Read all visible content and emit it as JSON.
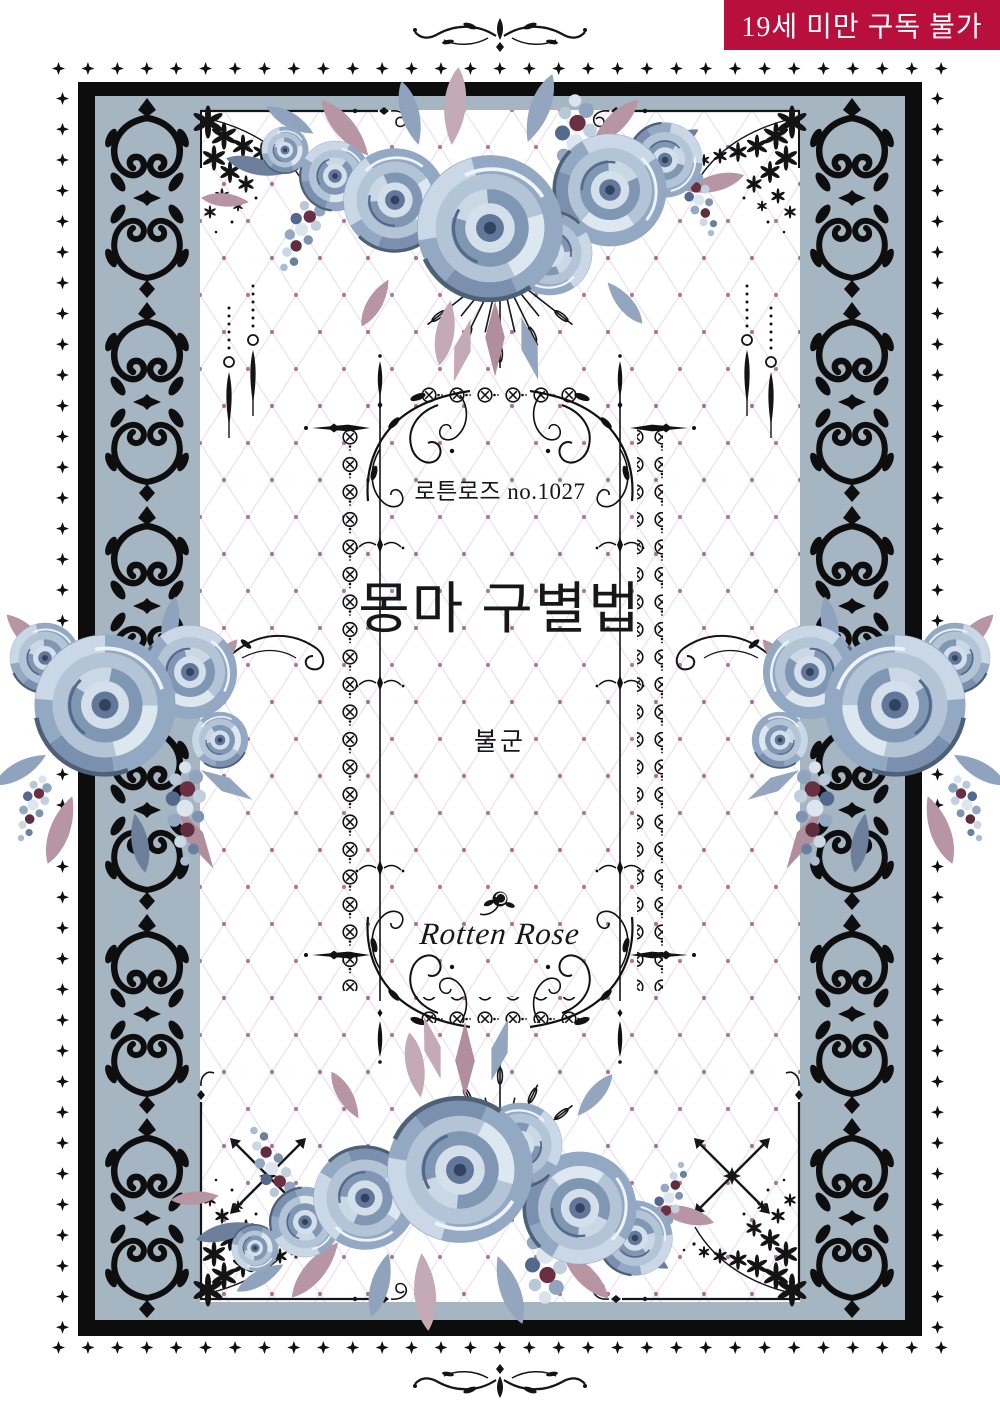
{
  "badge": {
    "label": "19세 미만 구독 불가"
  },
  "cover": {
    "series_label": "로튼로즈 no.1027",
    "title": "몽마 구별법",
    "author": "불군",
    "logo_text": "Rotten Rose"
  },
  "colors": {
    "badge_bg": "#b90f3c",
    "badge_fg": "#ffffff",
    "frame_black": "#0d0d0d",
    "slate": "#a5b5c2",
    "lattice_dot": "#b2708e",
    "text_dark": "#171717"
  },
  "icons": {
    "diamond-border-star": "four-pointed black star ✦",
    "circled-x-chain-motif": "circled X rosette ⊗",
    "spear-finial": "teardrop spike pendant",
    "winged-cross": "small winged cross on rule line",
    "crossed-arrows": "X of double-headed arrows",
    "bead-pendant": "hanging bead with drop",
    "needle-fan": "radiating needle lines",
    "rose-illustration": "watercolor blue-grey rose",
    "lilac-spray": "berry/lilac cluster",
    "damask-ornament": "black acanthus damask strip",
    "lace-corner": "black floral lace cascade",
    "logo-rose": "rose silhouette above logo script"
  }
}
